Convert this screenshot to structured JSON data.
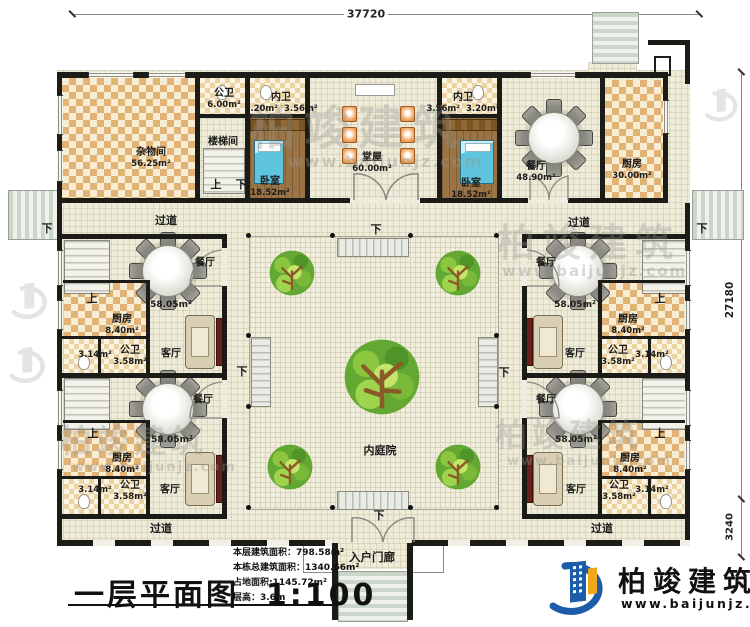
{
  "dimensions": {
    "top": "37720",
    "right": "27180",
    "bottom_right": "3240"
  },
  "title": {
    "text": "一层平面图",
    "scale": "1:100"
  },
  "stats": {
    "floor_area": "本层建筑面积：798.58m²",
    "total_area": "本栋总建筑面积：1340.66m²",
    "land_area": "占地面积:1145.72m²",
    "floor_height": "层高：3.6m"
  },
  "brand": {
    "name": "柏竣建筑",
    "url": "www.baijunjz.com"
  },
  "watermark": {
    "name": "柏竣建筑",
    "url": "www.baijunjz.com"
  },
  "markers": {
    "up": "上",
    "down": "下"
  },
  "rooms": {
    "storage": {
      "name": "杂物间",
      "area": "56.25m²"
    },
    "public_wc": {
      "name": "公卫",
      "area": "6.00m²"
    },
    "stair_room": {
      "name": "楼梯间"
    },
    "inner_wc": {
      "name": "内卫",
      "area_a": "3.20m²",
      "area_b": "3.56m²"
    },
    "bedroom": {
      "name": "卧室",
      "area": "18.52m²"
    },
    "hall": {
      "name": "堂屋",
      "area": "60.00m²"
    },
    "dining_main": {
      "name": "餐厅",
      "area": "48.90m²"
    },
    "kitchen_main": {
      "name": "厨房",
      "area": "30.00m²"
    },
    "dining_unit": {
      "name": "餐厅",
      "area": "58.05m²"
    },
    "kitchen_unit": {
      "name": "厨房",
      "area": "8.40m²"
    },
    "wc_unit": {
      "name": "公卫",
      "area_a": "3.58m²",
      "area_b": "3.14m²"
    },
    "living": {
      "name": "客厅"
    },
    "corridor": {
      "name": "过道"
    },
    "courtyard": {
      "name": "内庭院"
    },
    "porch": {
      "name": "入户门廊"
    }
  },
  "colors": {
    "wall": "#1b1b18",
    "floor": "#eeebd8",
    "checker": "#e2b377",
    "bedroom_floor": "#9b7445",
    "bed": "#5fc4dd",
    "tree_green": "#63a832",
    "logo_blue": "#1c5ca8",
    "logo_orange": "#f0a818",
    "chair_orange": "#d98436"
  }
}
